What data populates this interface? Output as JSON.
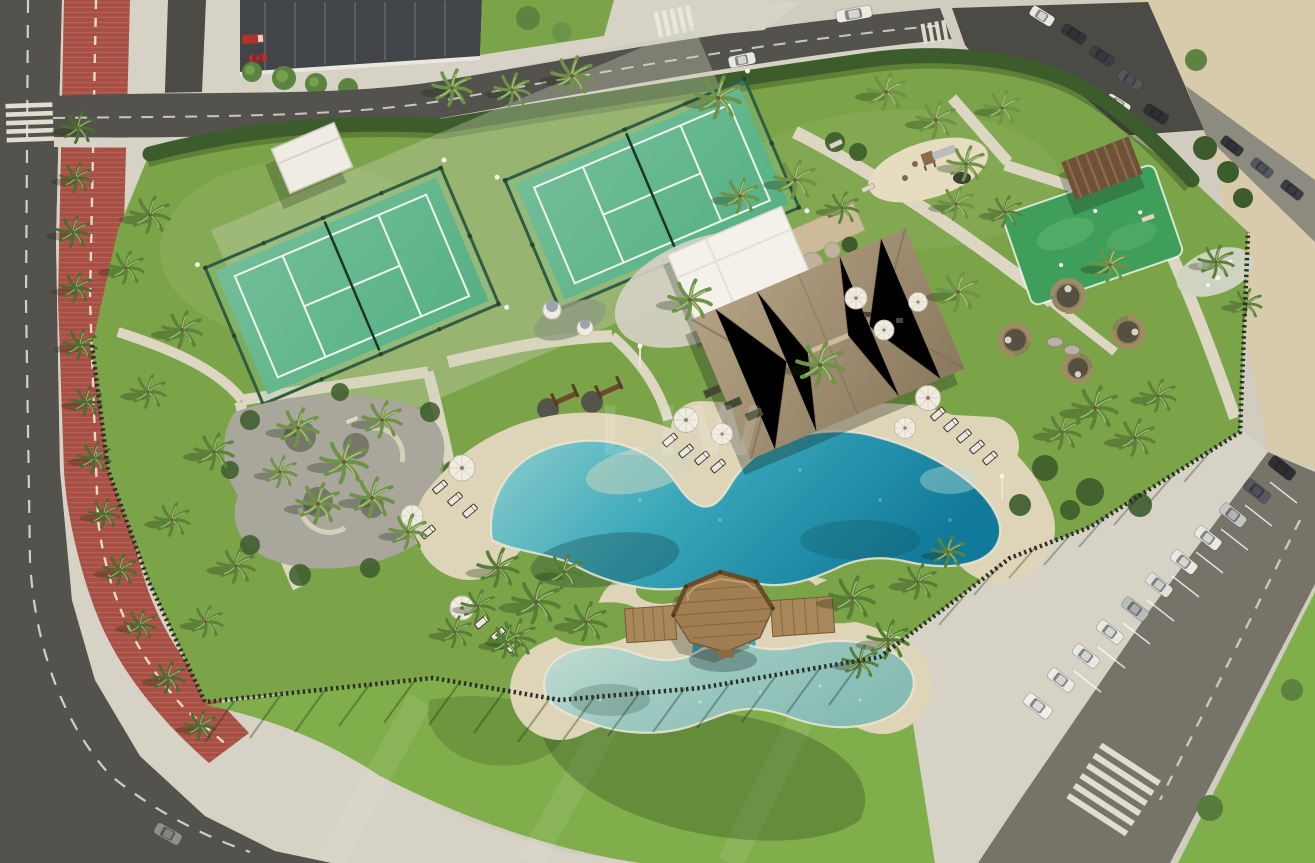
{
  "scene": {
    "alt": "Aerial 3D render of a beachfront resort leisure parcel: free-form lagoon pool with wooden gazebo island and kids pool, thatched-roof pool house, two fenced padel courts, playground, putting green, rattan lounge pods, palm-lined lawns, perimeter picket fence, red cycle lane and street parking with white cars.",
    "watermark": "LIW"
  },
  "colors": {
    "asphalt": "#53524d",
    "asphaltLight": "#767469",
    "asphaltDark": "#4b4a45",
    "sidewalk": "#d6d2c6",
    "path": "#ddd6c2",
    "sand": "#d8cbab",
    "bike": "#a84f44",
    "bikeStripe": "#c07f72",
    "hedge": "#3c5c2c",
    "grass": "#7ba449",
    "grassOut": "#7fae4a",
    "court": "#57b184",
    "courtFence": "#2f5d42",
    "poolDeep": "#117a9a",
    "poolMid": "#3aa8ba",
    "poolShallow": "#8fd0cc",
    "kidsPool": "#9cc8c0",
    "deckSand": "#ded4b8",
    "wood": "#a3845c",
    "woodDark": "#6f4f30",
    "thatchLight": "#b3a183",
    "thatchDark": "#8a795e",
    "fenceWood": "#2c2e26",
    "umbrella": "#f1ece0",
    "carWhite": "#e9e8e3",
    "carDark": "#33343a",
    "carSilver": "#c2c5c2",
    "gravel": "#a9a69b",
    "stone": "#cdbb98"
  }
}
